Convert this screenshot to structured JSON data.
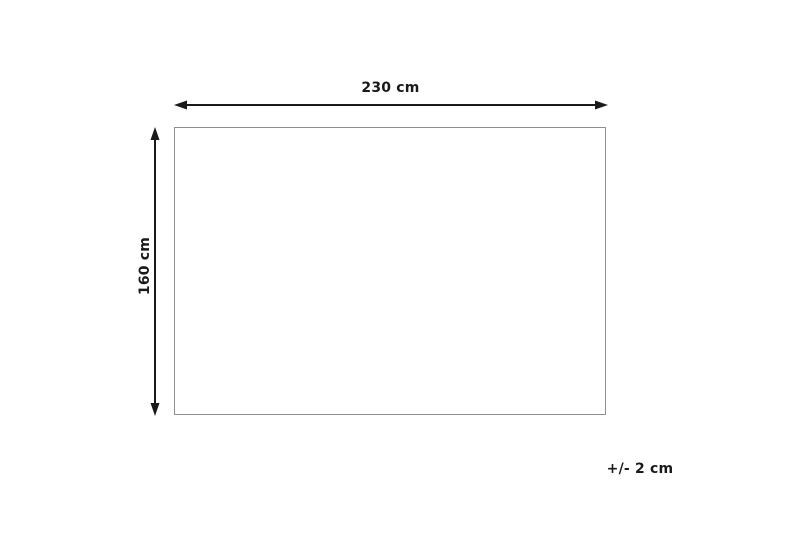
{
  "diagram": {
    "width_label": "230 cm",
    "height_label": "160 cm",
    "tolerance_label": "+/- 2 cm"
  },
  "icons": {
    "width_arrow": "horizontal-double-arrow",
    "height_arrow": "vertical-double-arrow"
  },
  "colors": {
    "arrow": "#1a1a1a",
    "outline": "#8f8f8f",
    "background": "#ffffff",
    "text": "#1a1a1a"
  }
}
